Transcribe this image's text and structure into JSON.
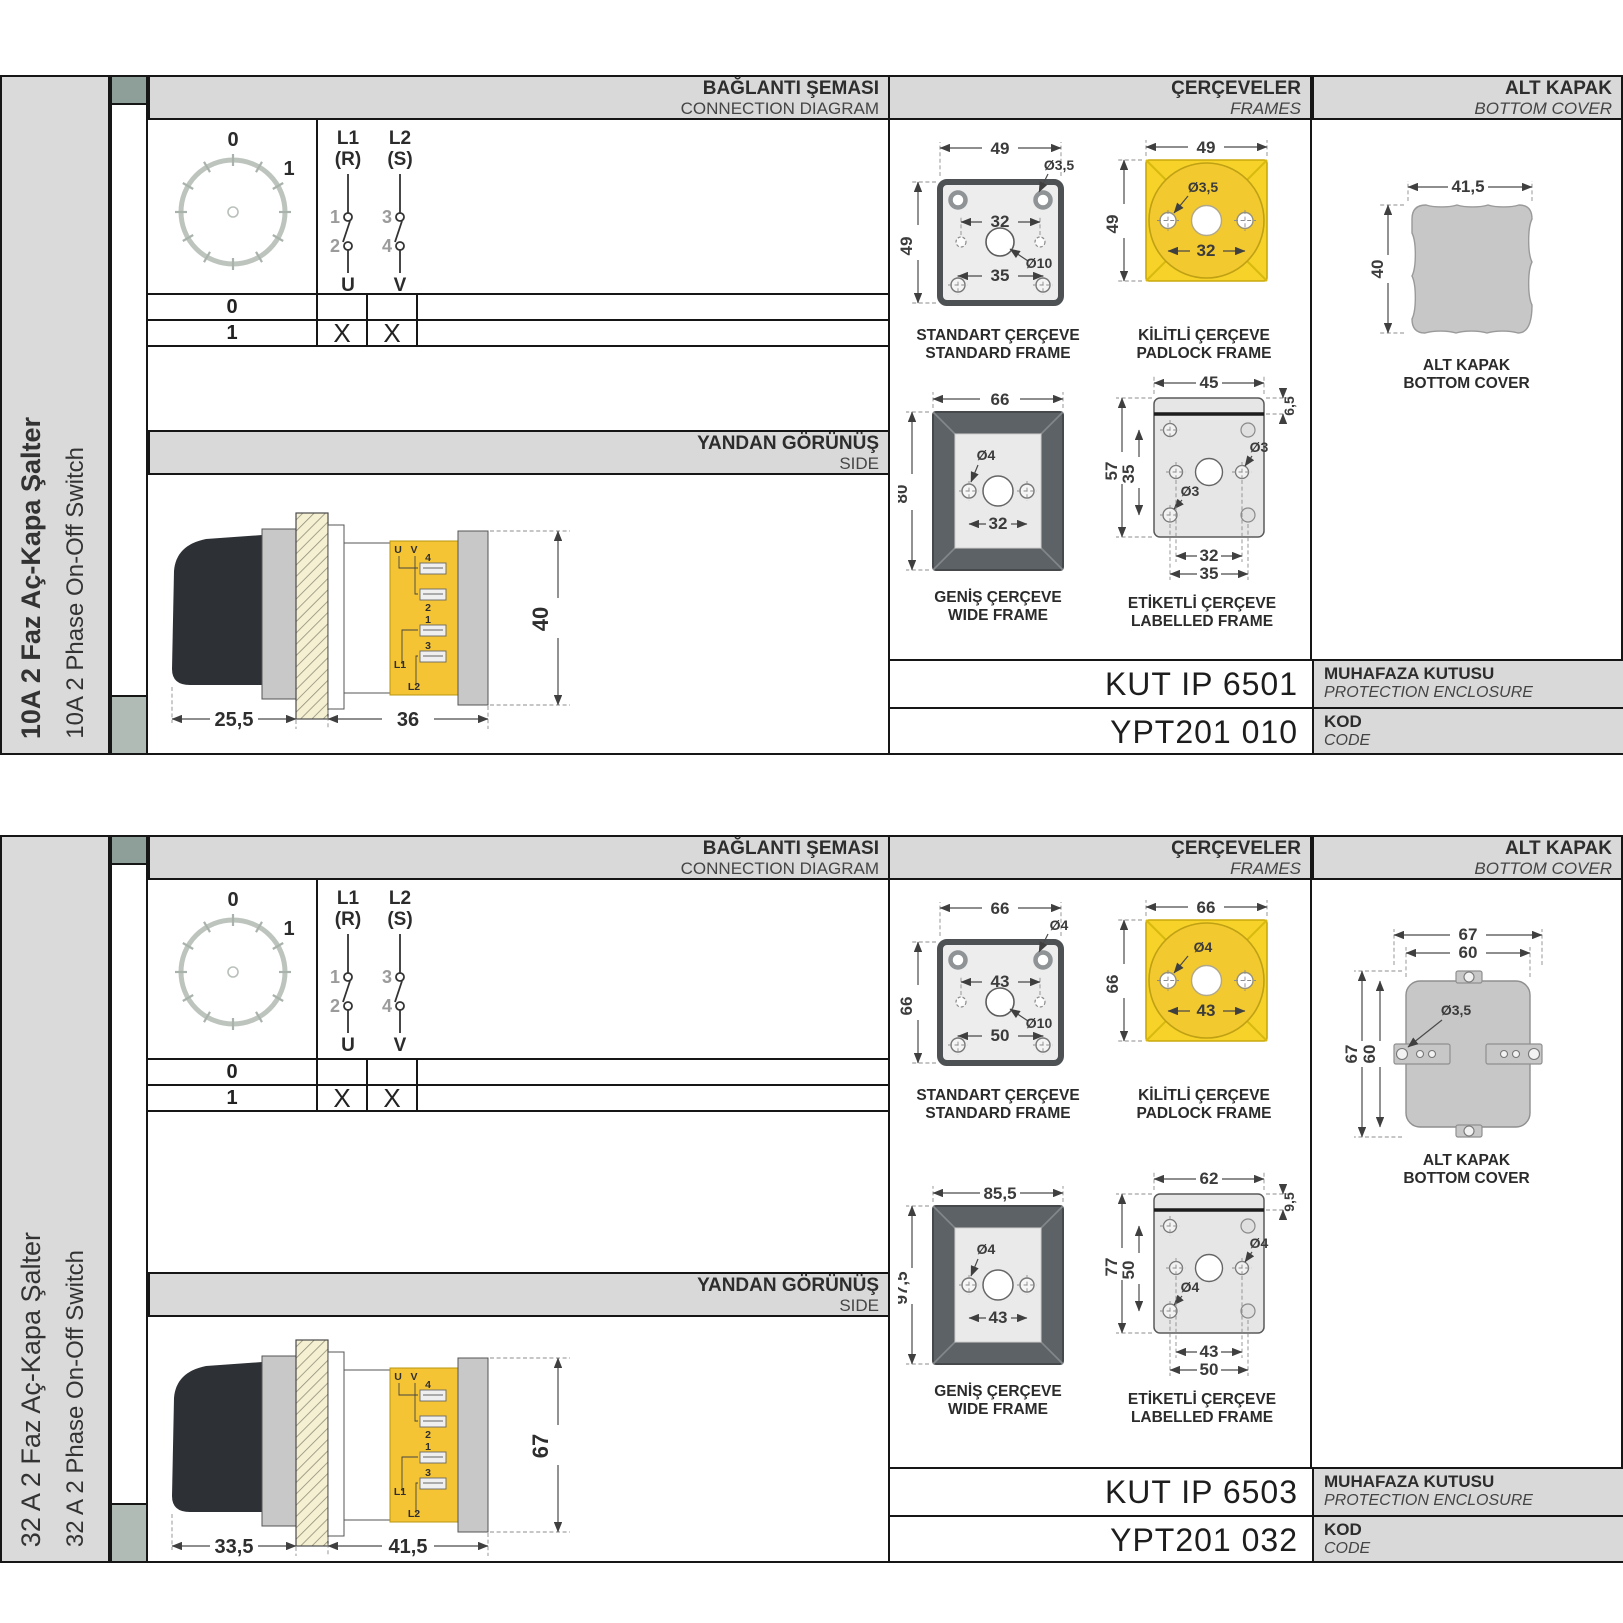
{
  "sections": [
    {
      "side_label_tr": "10A 2 Faz Aç-Kapa Şalter",
      "side_label_en": "10A 2 Phase On-Off Switch",
      "headers": {
        "diagram_tr": "BAĞLANTI ŞEMASI",
        "diagram_en": "CONNECTION DIAGRAM",
        "frames_tr": "ÇERÇEVELER",
        "frames_en": "FRAMES",
        "cover_tr": "ALT KAPAK",
        "cover_en": "BOTTOM COVER",
        "side_tr": "YANDAN GÖRÜNÜŞ",
        "side_en": "SIDE"
      },
      "diagram": {
        "pos_top": "0",
        "pos_right": "1",
        "pole1_top": "L1",
        "pole1_sub": "(R)",
        "pole2_top": "L2",
        "pole2_sub": "(S)",
        "n1": "1",
        "n2": "2",
        "n3": "3",
        "n4": "4",
        "out1": "U",
        "out2": "V",
        "row0": "0",
        "row1": "1",
        "x_u": "X",
        "x_v": "X"
      },
      "side_view": {
        "dim_a": "25,5",
        "dim_b": "36",
        "dim_h": "40",
        "t_u": "U",
        "t_v": "V",
        "t4": "4",
        "t2": "2",
        "t1": "1",
        "t3": "3",
        "tl1": "L1",
        "tl2": "L2"
      },
      "frames": {
        "standard": {
          "cap_tr": "STANDART ÇERÇEVE",
          "cap_en": "STANDARD FRAME",
          "w": "49",
          "h": "49",
          "hole": "Ø3,5",
          "inner": "32",
          "center": "Ø10",
          "lower": "35"
        },
        "padlock": {
          "cap_tr": "KİLİTLİ ÇERÇEVE",
          "cap_en": "PADLOCK FRAME",
          "w": "49",
          "h": "49",
          "hole": "Ø3,5",
          "inner": "32"
        },
        "wide": {
          "cap_tr": "GENİŞ ÇERÇEVE",
          "cap_en": "WIDE FRAME",
          "w": "66",
          "h": "80",
          "hole": "Ø4",
          "inner": "32"
        },
        "labelled": {
          "cap_tr": "ETİKETLİ ÇERÇEVE",
          "cap_en": "LABELLED FRAME",
          "w": "45",
          "band": "6,5",
          "h": "57",
          "inner_h": "35",
          "hole_mid": "Ø3",
          "hole_bot": "Ø3",
          "inner": "32",
          "outer": "35"
        }
      },
      "cover": {
        "cap_tr": "ALT KAPAK",
        "cap_en": "BOTTOM COVER",
        "w": "41,5",
        "h": "40"
      },
      "codes": {
        "enclosure": "KUT IP 6501",
        "enclosure_tr": "MUHAFAZA KUTUSU",
        "enclosure_en": "PROTECTION ENCLOSURE",
        "code": "YPT201 010",
        "code_tr": "KOD",
        "code_en": "CODE"
      }
    },
    {
      "side_label_tr": "32 A 2 Faz Aç-Kapa Şalter",
      "side_label_en": "32 A 2 Phase On-Off Switch",
      "headers": {
        "diagram_tr": "BAĞLANTI ŞEMASI",
        "diagram_en": "CONNECTION DIAGRAM",
        "frames_tr": "ÇERÇEVELER",
        "frames_en": "FRAMES",
        "cover_tr": "ALT KAPAK",
        "cover_en": "BOTTOM COVER",
        "side_tr": "YANDAN GÖRÜNÜŞ",
        "side_en": "SIDE"
      },
      "diagram": {
        "pos_top": "0",
        "pos_right": "1",
        "pole1_top": "L1",
        "pole1_sub": "(R)",
        "pole2_top": "L2",
        "pole2_sub": "(S)",
        "n1": "1",
        "n2": "2",
        "n3": "3",
        "n4": "4",
        "out1": "U",
        "out2": "V",
        "row0": "0",
        "row1": "1",
        "x_u": "X",
        "x_v": "X"
      },
      "side_view": {
        "dim_a": "33,5",
        "dim_b": "41,5",
        "dim_h": "67",
        "t_u": "U",
        "t_v": "V",
        "t4": "4",
        "t2": "2",
        "t1": "1",
        "t3": "3",
        "tl1": "L1",
        "tl2": "L2"
      },
      "frames": {
        "standard": {
          "cap_tr": "STANDART ÇERÇEVE",
          "cap_en": "STANDARD FRAME",
          "w": "66",
          "h": "66",
          "hole": "Ø4",
          "inner": "43",
          "center": "Ø10",
          "lower": "50"
        },
        "padlock": {
          "cap_tr": "KİLİTLİ ÇERÇEVE",
          "cap_en": "PADLOCK FRAME",
          "w": "66",
          "h": "66",
          "hole": "Ø4",
          "inner": "43"
        },
        "wide": {
          "cap_tr": "GENİŞ ÇERÇEVE",
          "cap_en": "WIDE FRAME",
          "w": "85,5",
          "h": "97,5",
          "hole": "Ø4",
          "inner": "43"
        },
        "labelled": {
          "cap_tr": "ETİKETLİ ÇERÇEVE",
          "cap_en": "LABELLED FRAME",
          "w": "62",
          "band": "9,5",
          "h": "77",
          "inner_h": "50",
          "hole_mid": "Ø4",
          "hole_bot": "Ø4",
          "inner": "43",
          "outer": "50"
        }
      },
      "cover": {
        "cap_tr": "ALT KAPAK",
        "cap_en": "BOTTOM COVER",
        "w_outer": "67",
        "w_inner": "60",
        "h_outer": "67",
        "h_inner": "60",
        "hole": "Ø3,5"
      },
      "codes": {
        "enclosure": "KUT IP 6503",
        "enclosure_tr": "MUHAFAZA KUTUSU",
        "enclosure_en": "PROTECTION ENCLOSURE",
        "code": "YPT201 032",
        "code_tr": "KOD",
        "code_en": "CODE"
      }
    }
  ]
}
